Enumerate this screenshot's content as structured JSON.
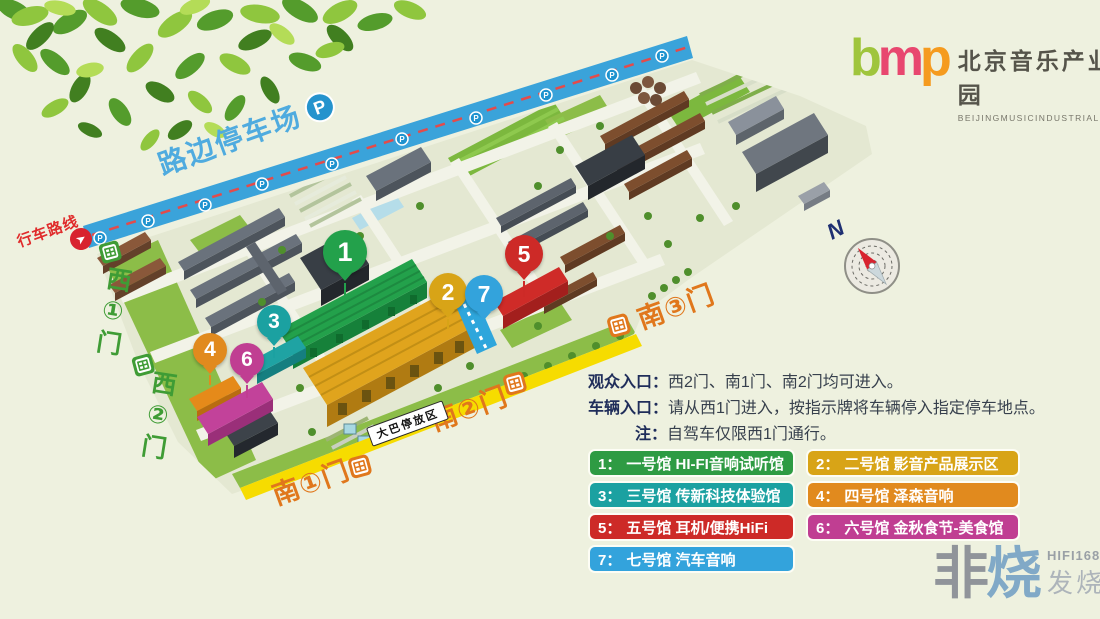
{
  "header": {
    "logo": {
      "letters": [
        {
          "ch": "b",
          "color": "#9fc53c"
        },
        {
          "ch": "m",
          "color": "#e8476f"
        },
        {
          "ch": "p",
          "color": "#f59b1f"
        }
      ],
      "title": "北京音乐产业园",
      "subtitle": "BEIJINGMUSICINDUSTRIALPARK"
    }
  },
  "map": {
    "roadside_parking": "路边停车场",
    "parking_badge": "P",
    "driving_route": "行车路线",
    "bus_parking": "大巴停放区",
    "compass_n": "N",
    "gates": {
      "west1": "西①门",
      "west2": "西②门",
      "south1": "南①门",
      "south2": "南②门",
      "south3": "南③门"
    },
    "markers": [
      {
        "num": "1",
        "color": "#23a14b"
      },
      {
        "num": "2",
        "color": "#d8a417"
      },
      {
        "num": "3",
        "color": "#1ba1a1"
      },
      {
        "num": "4",
        "color": "#e18a1e"
      },
      {
        "num": "5",
        "color": "#cd2a27"
      },
      {
        "num": "6",
        "color": "#c03e92"
      },
      {
        "num": "7",
        "color": "#33a3dc"
      }
    ]
  },
  "info": {
    "lines": [
      {
        "label": "观众入口：",
        "text": "西2门、南1门、南2门均可进入。"
      },
      {
        "label": "车辆入口：",
        "text": "请从西1门进入，按指示牌将车辆停入指定停车地点。"
      },
      {
        "label": "注：",
        "text": "自驾车仅限西1门通行。"
      }
    ]
  },
  "legend": [
    {
      "num": "1：",
      "text": "一号馆 HI-FI音响试听馆",
      "color": "#2e9b43"
    },
    {
      "num": "2：",
      "text": "二号馆 影音产品展示区",
      "color": "#d8a417"
    },
    {
      "num": "3：",
      "text": "三号馆 传新科技体验馆",
      "color": "#1ba1a1"
    },
    {
      "num": "4：",
      "text": "四号馆 泽森音响",
      "color": "#e18a1e"
    },
    {
      "num": "5：",
      "text": "五号馆 耳机/便携HiFi",
      "color": "#cd2a27"
    },
    {
      "num": "6：",
      "text": "六号馆 金秋食节-美食馆",
      "color": "#c03e92"
    },
    {
      "num": "7：",
      "text": "七号馆 汽车音响",
      "color": "#33a3dc"
    }
  ],
  "watermark": {
    "glyph1": "非",
    "glyph2": "烧",
    "site": "HIFI168.com",
    "name": "发烧网"
  }
}
